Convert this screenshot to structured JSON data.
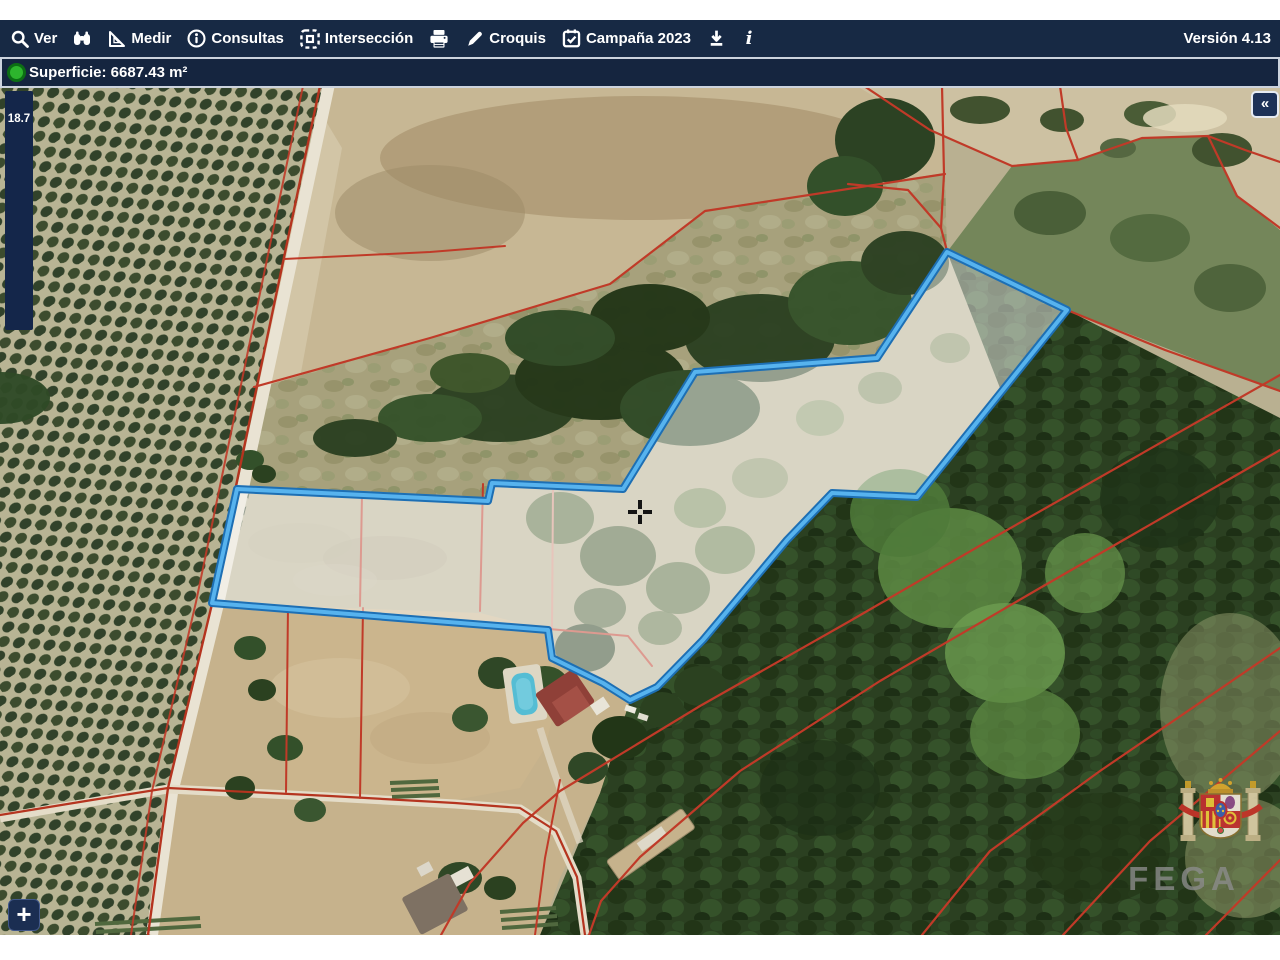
{
  "toolbar": {
    "bg_color": "#172944",
    "items": [
      {
        "icon": "magnifier-icon",
        "label": "Ver"
      },
      {
        "icon": "binoculars-icon",
        "label": ""
      },
      {
        "icon": "ruler-icon",
        "label": "Medir"
      },
      {
        "icon": "info-circle-icon",
        "label": "Consultas"
      },
      {
        "icon": "intersection-icon",
        "label": "Intersección"
      },
      {
        "icon": "printer-icon",
        "label": ""
      },
      {
        "icon": "pencil-icon",
        "label": "Croquis"
      },
      {
        "icon": "calendar-check-icon",
        "label": "Campaña 2023"
      },
      {
        "icon": "download-icon",
        "label": ""
      },
      {
        "icon": "info-italic-icon",
        "label": ""
      }
    ],
    "version_label": "Versión 4.13"
  },
  "statusbar": {
    "text": "Superficie: 6687.43 m²",
    "dot_color": "#2db52d"
  },
  "map": {
    "scale_indicator": "18.7",
    "zoom_in_label": "+",
    "collapse_label": "«",
    "fega_label": "FEGA",
    "parcel_points": "237,401 488,413 492,395 623,401 695,284 877,270 947,164 1067,222 917,409 832,405 787,452 703,552 657,599 630,612 603,595 552,570 548,542 212,515",
    "colors": {
      "parcel_fill": "rgba(250,250,247,0.5)",
      "parcel_stroke": "#57b3ee",
      "parcel_casing": "#1d6fb4",
      "boundary_red": "#c03a28"
    }
  }
}
